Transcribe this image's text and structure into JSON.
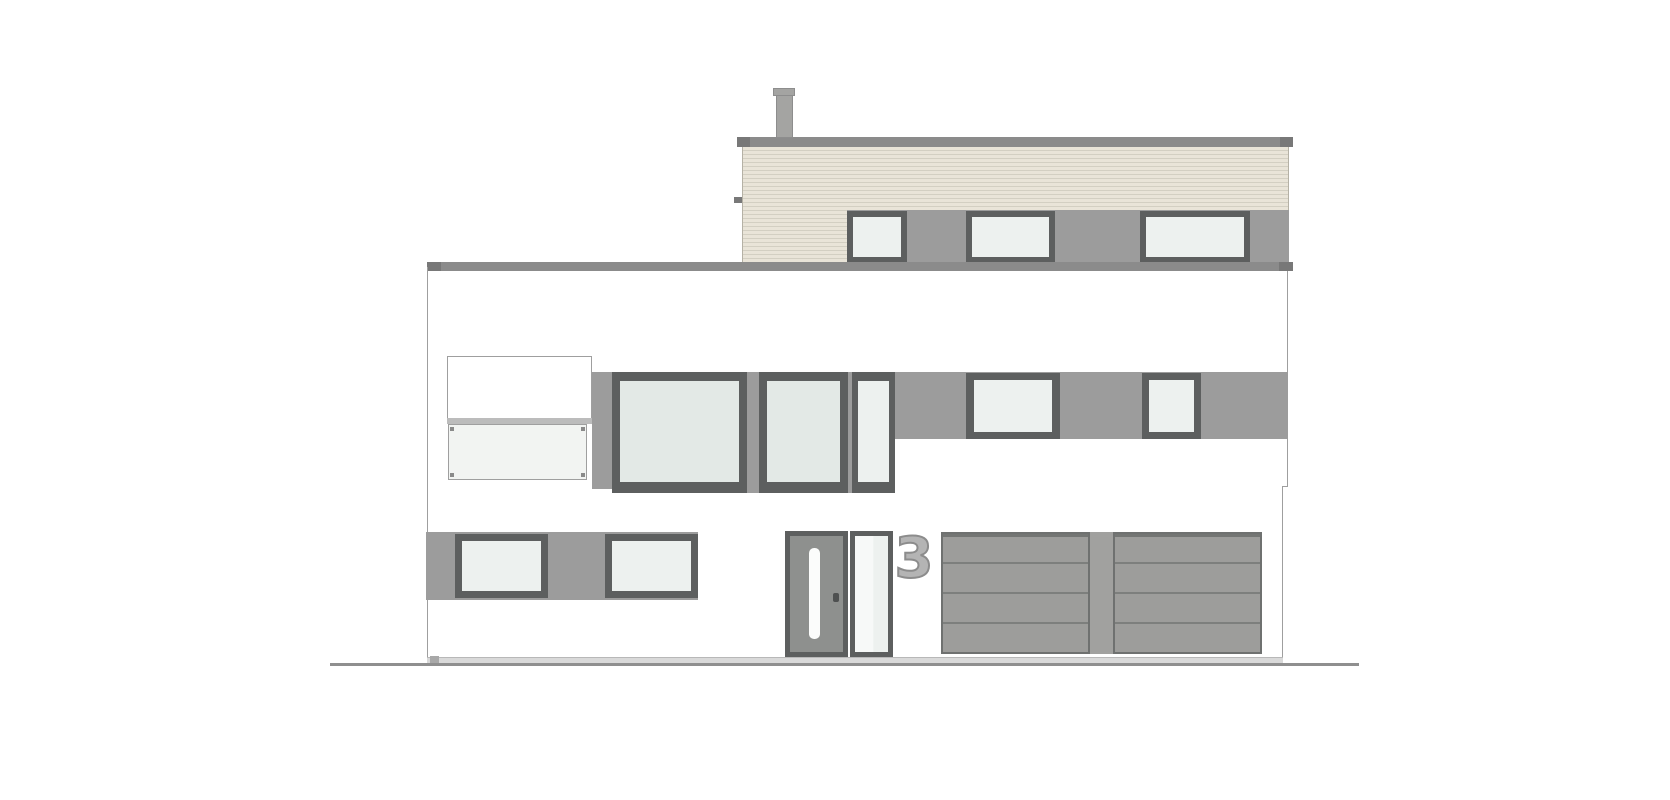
{
  "house_number": "3",
  "colors": {
    "white": "#ffffff",
    "roof": "#8b8b8b",
    "roof_tab": "#787878",
    "band": "#9c9c9c",
    "frame": "#5d5f5f",
    "glass_bright": "#edf1ef",
    "glass_tall": "#e3e9e6",
    "glass_rail": "#f2f4f2",
    "cladding": "#e9e4d8",
    "cladding_line": "#d3cfc2",
    "cladding_edge": "#b5b1a5",
    "door_leaf": "#8e908e",
    "door_glass": "#fbfcfb",
    "handle": "#4e5050",
    "garage_fill": "#9d9d9b",
    "garage_line": "#7d7f7d",
    "garage_border": "#6f7170",
    "garage_top": "#747674",
    "pillar": "#a1a19f",
    "chimney": "#a4a4a2",
    "chimney_edge": "#8d8d8d",
    "outline": "#9f9f9f",
    "parapet_sill": "#bcbcbc",
    "dot": "#8a8a8a",
    "sill": "#d9d9d9",
    "foot": "#a8a8a8",
    "ground": "#8f8f8f",
    "number_fill": "#b4b4b4",
    "number_stroke": "#8c8c8c"
  },
  "scene": {
    "width": 1670,
    "height": 800,
    "rects": [
      {
        "n": "upper-roof-slab",
        "x": 737,
        "y": 137,
        "w": 556,
        "h": 10,
        "f": "roof"
      },
      {
        "n": "upper-roof-end-left",
        "x": 737,
        "y": 137,
        "w": 13,
        "h": 10,
        "f": "roof_tab"
      },
      {
        "n": "upper-roof-end-right",
        "x": 1280,
        "y": 137,
        "w": 13,
        "h": 10,
        "f": "roof_tab"
      },
      {
        "n": "chimney",
        "x": 776,
        "y": 94,
        "w": 17,
        "h": 44,
        "f": "chimney",
        "b": "chimney_edge"
      },
      {
        "n": "chimney-cap",
        "x": 773,
        "y": 88,
        "w": 22,
        "h": 8,
        "f": "chimney",
        "b": "chimney_edge"
      },
      {
        "n": "upper-storey-cladding",
        "x": 742,
        "y": 147,
        "w": 547,
        "h": 115,
        "cls": "cladding"
      },
      {
        "n": "cladding-tick",
        "x": 734,
        "y": 197,
        "w": 8,
        "h": 6,
        "f": "roof_tab"
      },
      {
        "n": "upper-window-band",
        "x": 847,
        "y": 210,
        "w": 442,
        "h": 52,
        "f": "band"
      },
      {
        "n": "upper-window-1-frame",
        "x": 847,
        "y": 211,
        "w": 60,
        "h": 51,
        "f": "frame"
      },
      {
        "n": "upper-window-1-glass",
        "x": 853,
        "y": 217,
        "w": 48,
        "h": 40,
        "f": "glass_bright"
      },
      {
        "n": "upper-window-2-frame",
        "x": 966,
        "y": 211,
        "w": 89,
        "h": 51,
        "f": "frame"
      },
      {
        "n": "upper-window-2-glass",
        "x": 972,
        "y": 217,
        "w": 77,
        "h": 40,
        "f": "glass_bright"
      },
      {
        "n": "upper-window-3-frame",
        "x": 1140,
        "y": 211,
        "w": 110,
        "h": 51,
        "f": "frame"
      },
      {
        "n": "upper-window-3-glass",
        "x": 1146,
        "y": 217,
        "w": 98,
        "h": 40,
        "f": "glass_bright"
      },
      {
        "n": "main-roof-slab",
        "x": 427,
        "y": 262,
        "w": 866,
        "h": 9,
        "f": "roof"
      },
      {
        "n": "main-roof-end-left",
        "x": 427,
        "y": 262,
        "w": 14,
        "h": 9,
        "f": "roof_tab"
      },
      {
        "n": "main-roof-end-right",
        "x": 1279,
        "y": 262,
        "w": 14,
        "h": 9,
        "f": "roof_tab"
      },
      {
        "n": "wall-left-line",
        "x": 427,
        "y": 267,
        "w": 1,
        "h": 391,
        "f": "outline"
      },
      {
        "n": "wall-right-line-upper",
        "x": 1287,
        "y": 271,
        "w": 1,
        "h": 216,
        "f": "outline"
      },
      {
        "n": "wall-right-jog",
        "x": 1282,
        "y": 486,
        "w": 6,
        "h": 1,
        "f": "outline"
      },
      {
        "n": "wall-right-line-lower",
        "x": 1282,
        "y": 487,
        "w": 1,
        "h": 171,
        "f": "outline"
      },
      {
        "n": "balcony-parapet",
        "x": 447,
        "y": 356,
        "w": 145,
        "h": 66,
        "f": "white",
        "b": "outline"
      },
      {
        "n": "balcony-parapet-sill",
        "x": 447,
        "y": 418,
        "w": 145,
        "h": 6,
        "f": "parapet_sill"
      },
      {
        "n": "balcony-glass-railing",
        "x": 448,
        "y": 424,
        "w": 139,
        "h": 56,
        "f": "glass_rail",
        "b": "outline"
      },
      {
        "n": "railing-fixing-dot-tl",
        "x": 450,
        "y": 427,
        "w": 4,
        "h": 4,
        "f": "dot"
      },
      {
        "n": "railing-fixing-dot-tr",
        "x": 581,
        "y": 427,
        "w": 4,
        "h": 4,
        "f": "dot"
      },
      {
        "n": "railing-fixing-dot-bl",
        "x": 450,
        "y": 473,
        "w": 4,
        "h": 4,
        "f": "dot"
      },
      {
        "n": "railing-fixing-dot-br",
        "x": 581,
        "y": 473,
        "w": 4,
        "h": 4,
        "f": "dot"
      },
      {
        "n": "main-window-left-strip",
        "x": 592,
        "y": 372,
        "w": 20,
        "h": 117,
        "f": "band"
      },
      {
        "n": "main-window-1-frame",
        "x": 612,
        "y": 372,
        "w": 135,
        "h": 121,
        "f": "frame"
      },
      {
        "n": "main-window-1-glass",
        "x": 620,
        "y": 381,
        "w": 119,
        "h": 101,
        "f": "glass_tall"
      },
      {
        "n": "main-window-mullion-1",
        "x": 747,
        "y": 372,
        "w": 12,
        "h": 121,
        "f": "band"
      },
      {
        "n": "main-window-2-frame",
        "x": 759,
        "y": 372,
        "w": 89,
        "h": 121,
        "f": "frame"
      },
      {
        "n": "main-window-2-glass",
        "x": 767,
        "y": 381,
        "w": 73,
        "h": 101,
        "f": "glass_tall"
      },
      {
        "n": "main-window-mullion-2",
        "x": 848,
        "y": 372,
        "w": 4,
        "h": 121,
        "f": "band"
      },
      {
        "n": "main-window-3-frame",
        "x": 852,
        "y": 372,
        "w": 43,
        "h": 121,
        "f": "frame"
      },
      {
        "n": "main-window-3-glass",
        "x": 858,
        "y": 381,
        "w": 31,
        "h": 101,
        "f": "glass_bright"
      },
      {
        "n": "middle-band-right",
        "x": 895,
        "y": 372,
        "w": 393,
        "h": 67,
        "f": "band"
      },
      {
        "n": "middle-window-1-frame",
        "x": 966,
        "y": 373,
        "w": 94,
        "h": 66,
        "f": "frame"
      },
      {
        "n": "middle-window-1-glass",
        "x": 974,
        "y": 380,
        "w": 78,
        "h": 52,
        "f": "glass_bright"
      },
      {
        "n": "middle-window-2-frame",
        "x": 1142,
        "y": 373,
        "w": 59,
        "h": 66,
        "f": "frame"
      },
      {
        "n": "middle-window-2-glass",
        "x": 1149,
        "y": 380,
        "w": 45,
        "h": 52,
        "f": "glass_bright"
      },
      {
        "n": "ground-floor-band",
        "x": 426,
        "y": 532,
        "w": 272,
        "h": 68,
        "f": "band"
      },
      {
        "n": "ground-window-1-frame",
        "x": 455,
        "y": 534,
        "w": 93,
        "h": 64,
        "f": "frame"
      },
      {
        "n": "ground-window-1-glass",
        "x": 462,
        "y": 541,
        "w": 79,
        "h": 50,
        "f": "glass_bright"
      },
      {
        "n": "ground-window-2-frame",
        "x": 605,
        "y": 534,
        "w": 93,
        "h": 64,
        "f": "frame"
      },
      {
        "n": "ground-window-2-glass",
        "x": 612,
        "y": 541,
        "w": 79,
        "h": 50,
        "f": "glass_bright"
      },
      {
        "n": "entry-door-frame",
        "x": 785,
        "y": 531,
        "w": 63,
        "h": 126,
        "f": "frame"
      },
      {
        "n": "entry-door-leaf",
        "x": 790,
        "y": 536,
        "w": 53,
        "h": 116,
        "f": "door_leaf"
      },
      {
        "n": "entry-door-glass-stripe",
        "x": 809,
        "y": 548,
        "w": 11,
        "h": 91,
        "f": "door_glass",
        "r": 5
      },
      {
        "n": "entry-door-handle",
        "x": 833,
        "y": 593,
        "w": 6,
        "h": 9,
        "f": "handle",
        "r": 2
      },
      {
        "n": "entry-sidelight-frame",
        "x": 850,
        "y": 531,
        "w": 43,
        "h": 126,
        "f": "frame"
      },
      {
        "n": "entry-sidelight-glass",
        "x": 855,
        "y": 536,
        "w": 33,
        "h": 116,
        "cls": "sidelight-glass"
      },
      {
        "n": "garage-door-left",
        "x": 941,
        "y": 532,
        "w": 149,
        "h": 122,
        "cls": "garage"
      },
      {
        "n": "garage-pillar",
        "x": 1090,
        "y": 532,
        "w": 23,
        "h": 122,
        "f": "pillar"
      },
      {
        "n": "garage-door-right",
        "x": 1113,
        "y": 532,
        "w": 149,
        "h": 122,
        "cls": "garage"
      },
      {
        "n": "base-sill",
        "x": 427,
        "y": 657,
        "w": 856,
        "h": 6,
        "f": "sill",
        "cls": "sill-top"
      },
      {
        "n": "base-foot",
        "x": 430,
        "y": 656,
        "w": 9,
        "h": 10,
        "f": "foot"
      },
      {
        "n": "ground-line",
        "x": 330,
        "y": 663,
        "w": 1029,
        "h": 3,
        "f": "ground"
      }
    ]
  }
}
